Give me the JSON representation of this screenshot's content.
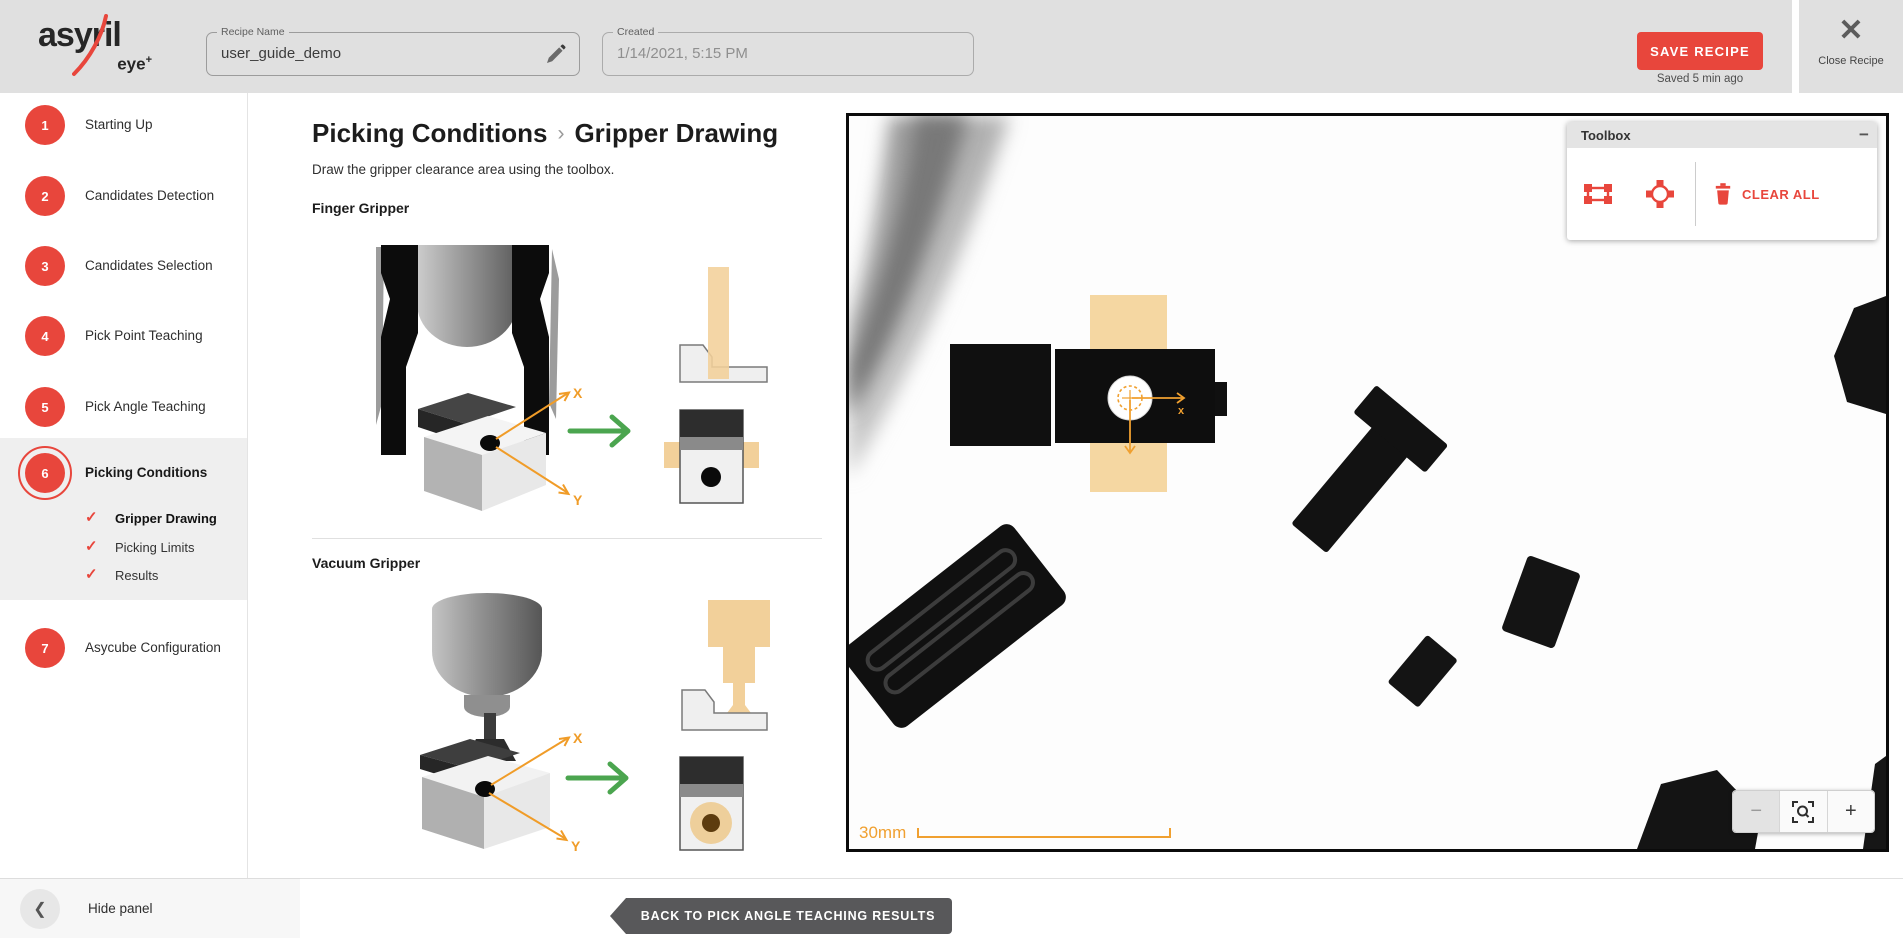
{
  "icons": {
    "close": "✕",
    "collapse_minus": "−",
    "zoom_out": "−",
    "zoom_in": "+",
    "chevron_left": "❮",
    "check": "✓"
  },
  "header": {
    "brand": {
      "name": "asyril",
      "product": "eye",
      "plus": "+"
    },
    "recipe_name": {
      "label": "Recipe Name",
      "value": "user_guide_demo"
    },
    "created": {
      "label": "Created",
      "value": "1/14/2021, 5:15 PM"
    },
    "save_button_label": "SAVE RECIPE",
    "saved_status": "Saved 5 min ago",
    "close_label": "Close Recipe"
  },
  "sidebar": {
    "steps": [
      {
        "num": "1",
        "label": "Starting Up"
      },
      {
        "num": "2",
        "label": "Candidates Detection"
      },
      {
        "num": "3",
        "label": "Candidates Selection"
      },
      {
        "num": "4",
        "label": "Pick Point Teaching"
      },
      {
        "num": "5",
        "label": "Pick Angle Teaching"
      },
      {
        "num": "6",
        "label": "Picking Conditions"
      },
      {
        "num": "7",
        "label": "Asycube Configuration"
      }
    ],
    "active_step": "6",
    "substeps": [
      {
        "label": "Gripper Drawing",
        "checked": true,
        "active": true
      },
      {
        "label": "Picking Limits",
        "checked": true,
        "active": false
      },
      {
        "label": "Results",
        "checked": true,
        "active": false
      }
    ],
    "hide_panel_label": "Hide panel"
  },
  "content": {
    "breadcrumb_parent": "Picking Conditions",
    "breadcrumb_separator": "›",
    "title": "Gripper Drawing",
    "subtitle": "Draw the gripper clearance area using the toolbox.",
    "sections": [
      {
        "title": "Finger Gripper"
      },
      {
        "title": "Vacuum Gripper"
      }
    ],
    "axis_x_label": "X",
    "axis_y_label": "Y"
  },
  "viewer": {
    "toolbox": {
      "title": "Toolbox",
      "clear_all_label": "CLEAR ALL"
    },
    "scale_label": "30mm",
    "marker_x_label": "x"
  },
  "footer": {
    "back_button_label": "BACK TO PICK ANGLE TEACHING RESULTS",
    "next_button_label": "DEFINE PICKING LIMITS"
  },
  "colors": {
    "accent_red": "#e8463c",
    "axis_orange": "#f09c28",
    "clearance_tan": "#f2d09a",
    "arrow_green": "#4ba54f",
    "header_gray": "#e0e0e0"
  }
}
